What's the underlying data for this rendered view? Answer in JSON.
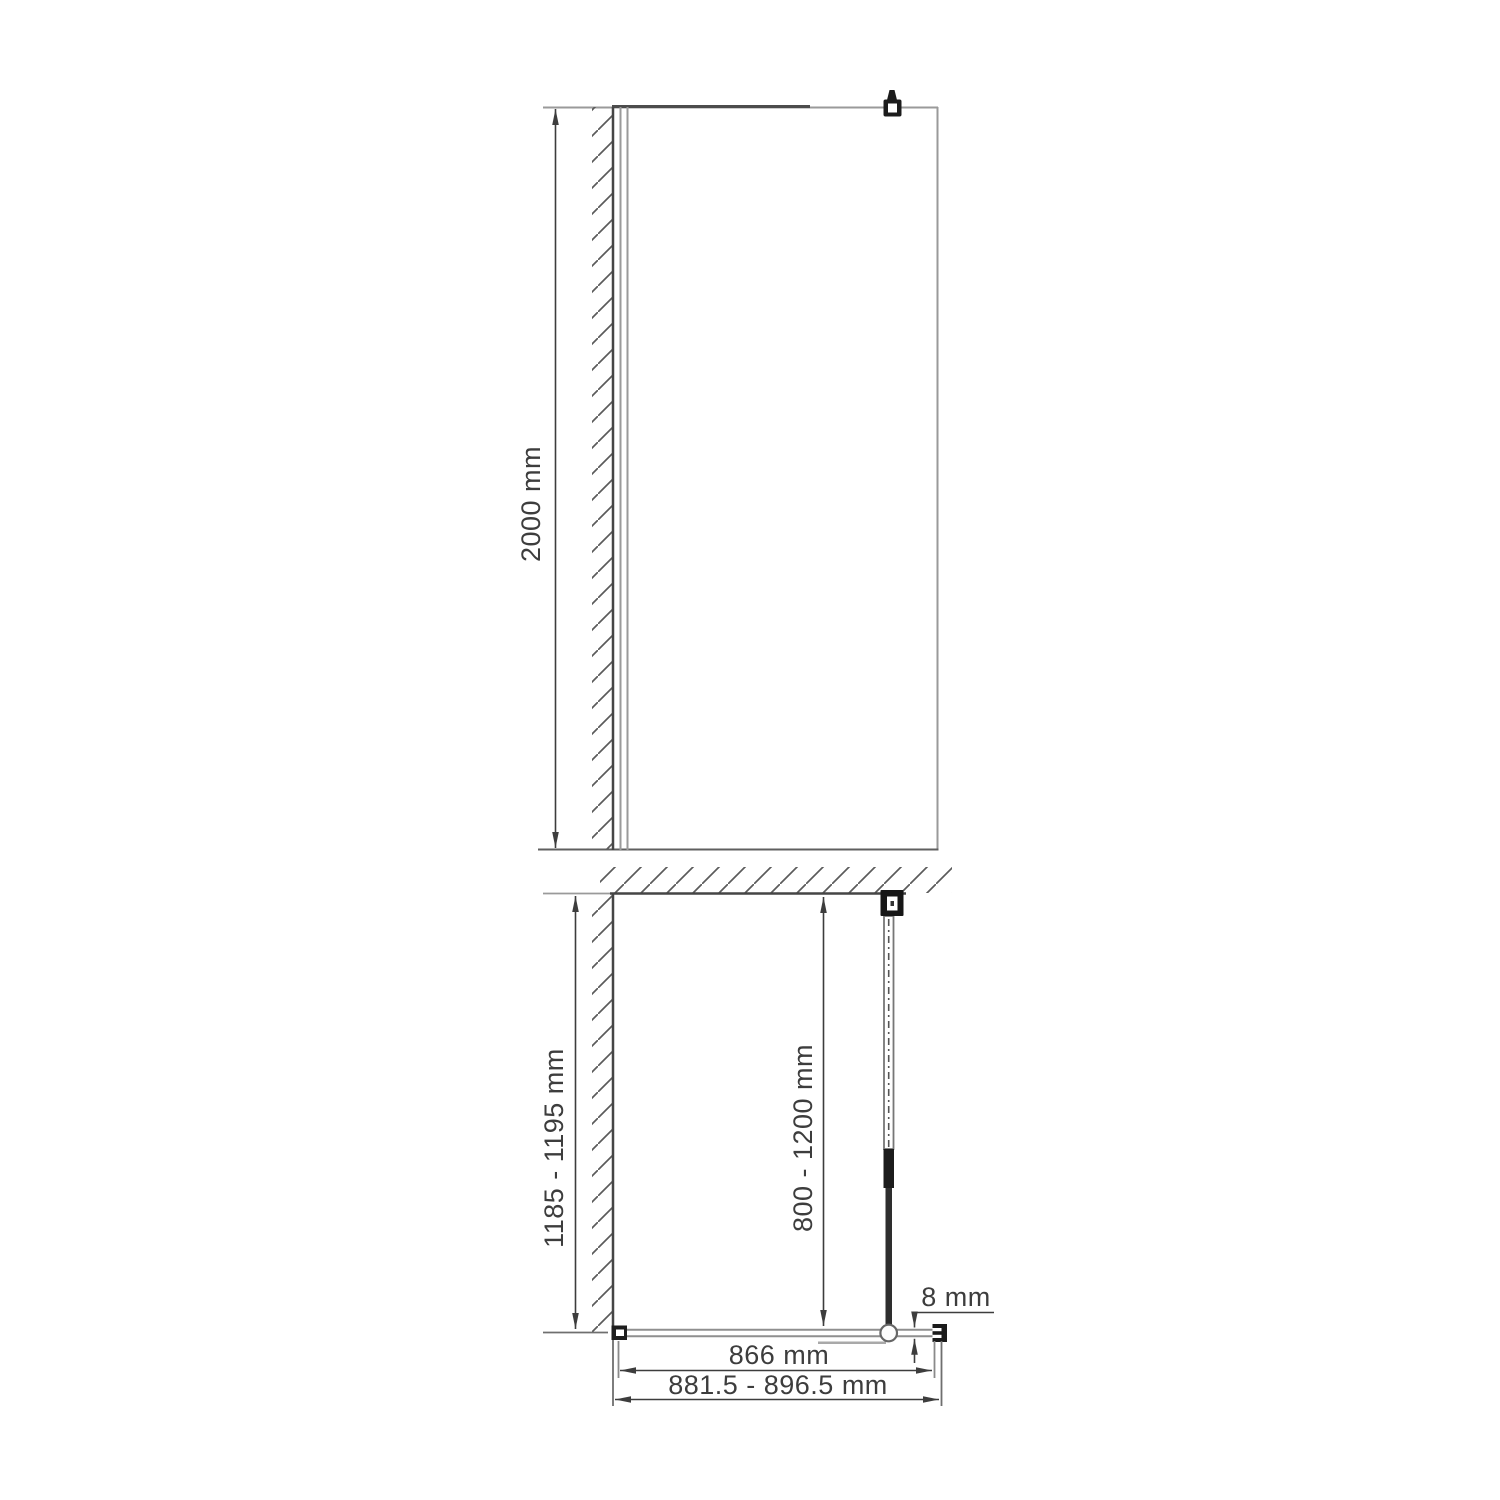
{
  "page": {
    "background": "#ffffff",
    "kind": "technical-installation-drawing"
  },
  "dimensions": {
    "panel_height": "2000 mm",
    "side_wall_depth": "1185 - 1195 mm",
    "support_bar_length": "800 - 1200 mm",
    "glass_thickness": "8 mm",
    "glass_width": "866 mm",
    "overall_width": "881.5 - 896.5 mm"
  },
  "colors": {
    "background": "#ffffff",
    "thin_line": "#8f8f8f",
    "dark_line": "#454545",
    "dimension_line": "#3d3d3d",
    "bracket_fill": "#1c1c1c",
    "text": "#3d3d3d"
  },
  "icons": {
    "wall_hatch": "diagonal-hatch",
    "top_bracket": "glass-clamp",
    "wall_bracket": "support-bar-wall-mount",
    "glass_clamp_circle": "support-bar-glass-clamp",
    "end_cap": "glass-end-profile"
  }
}
